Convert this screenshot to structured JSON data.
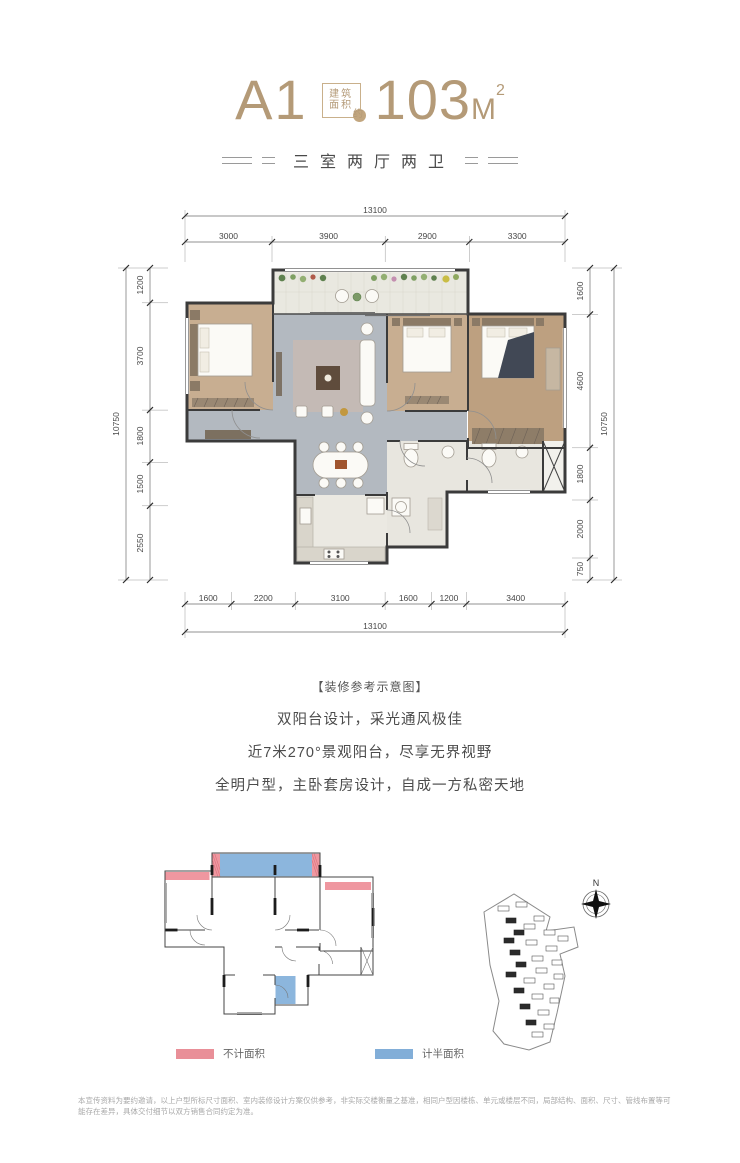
{
  "header": {
    "unit_name": "A1",
    "badge_line1": "建筑",
    "badge_line2": "面积",
    "badge_circle": "约",
    "area_value": "103",
    "area_unit": "M",
    "area_sup": "2",
    "subtitle": "三室两厅两卫"
  },
  "plan": {
    "caption": "【装修参考示意图】",
    "dims": {
      "top_total": "13100",
      "top_segments": [
        "3000",
        "3900",
        "2900",
        "3300"
      ],
      "bottom_segments": [
        "1600",
        "2200",
        "3100",
        "1600",
        "1200",
        "3400"
      ],
      "bottom_total": "13100",
      "left_total": "10750",
      "left_segments": [
        "1200",
        "3700",
        "1800",
        "1500",
        "2550"
      ],
      "right_segments": [
        "1600",
        "4600",
        "1800",
        "2000",
        "750"
      ],
      "right_total": "10750"
    }
  },
  "features": [
    "双阳台设计，采光通风极佳",
    "近7米270°景观阳台，尽享无界视野",
    "全明户型，主卧套房设计，自成一方私密天地"
  ],
  "legend": {
    "excluded": {
      "label": "不计面积",
      "color": "#e98f98"
    },
    "half": {
      "label": "计半面积",
      "color": "#82aed8"
    }
  },
  "site": {
    "north_label": "N"
  },
  "disclaimer": "本宣传资料为要约邀请，以上户型所标尺寸面积、室内装修设计方案仅供参考，非实际交楼衡量之基准，相同户型因楼栋、单元或楼层不同，局部结构、面积、尺寸、管线布置等可能存在差异，具体交付细节以双方销售合同约定为准。"
}
